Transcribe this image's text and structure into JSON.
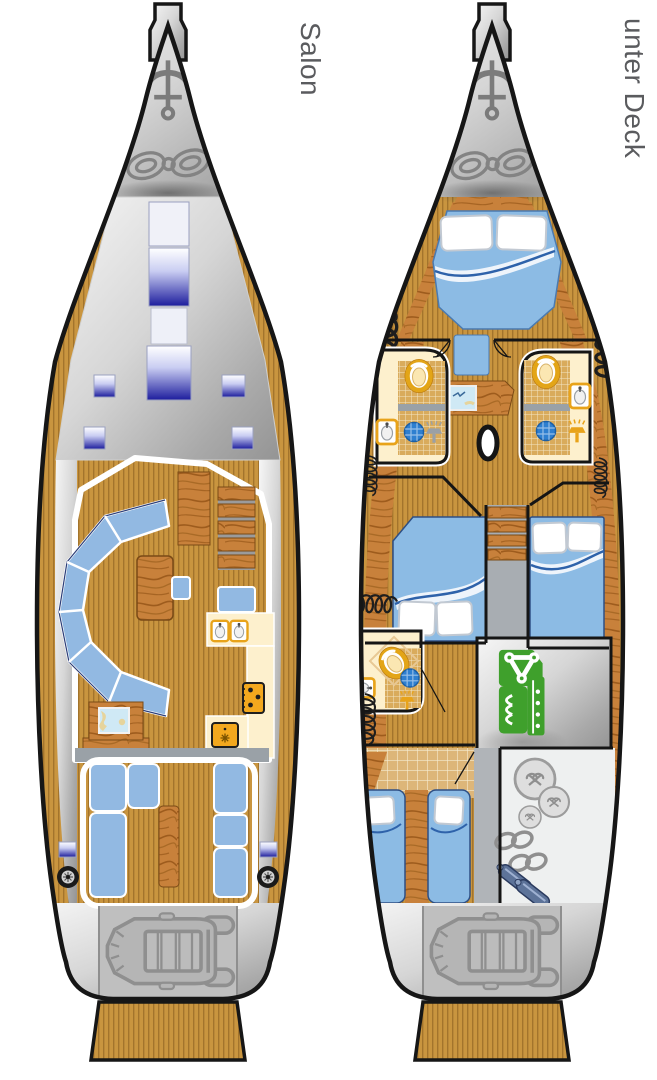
{
  "page": {
    "width": 657,
    "height": 1080,
    "background": "#ffffff",
    "type": "sailing-yacht-layout-diagram"
  },
  "labels": {
    "salon": "Salon",
    "lower_deck": "unter Deck"
  },
  "palette": {
    "label_gray": "#5a5b5e",
    "hull_outline": "#161616",
    "teak": "#c9953f",
    "teak_stripe": "#a3742c",
    "wood": "#c8813b",
    "wood_grain": "#9e5c1d",
    "deck_silver_light": "#f6f6f6",
    "deck_silver_dark": "#949494",
    "hatch_navy": "#1d1d9d",
    "cushion_blue": "#92b9e2",
    "bed_blue": "#8cbbe4",
    "galley_cream": "#fdf0cd",
    "appliance_orange": "#f3a81e",
    "drain_blue": "#2e7fd0",
    "engine_green": "#3fa02c",
    "bulkhead_gray": "#9aa1a7",
    "storage_gray": "#eef0f0",
    "map_blue": "#cfe9f5"
  },
  "decks": [
    {
      "id": "salon-deck",
      "label": "Salon",
      "features": [
        "bow-anchor",
        "rope-locker",
        "deck-skylights",
        "u-shaped-settee",
        "salon-table",
        "stool",
        "sideboard",
        "companionway-steps",
        "nav-seat",
        "galley-double-sink",
        "stove",
        "fridge",
        "chart-table",
        "cockpit-seating",
        "cockpit-table",
        "winch-port",
        "winch-starboard",
        "stern-hatches",
        "dinghy-garage",
        "swim-platform"
      ]
    },
    {
      "id": "lower-deck",
      "label": "unter Deck",
      "features": [
        "bow-anchor",
        "rope-locker",
        "forward-v-berth",
        "hanging-wardrobes",
        "head-port",
        "head-starboard",
        "head-aft",
        "toilets",
        "wash-basins",
        "shower-drains",
        "seat",
        "chart-desk",
        "mast",
        "double-bed-port",
        "double-bed-starboard",
        "companionway-stairs",
        "engine-room",
        "aft-single-beds",
        "storage-fenders-ropes",
        "dinghy-garage",
        "swim-platform"
      ]
    }
  ],
  "icons": [
    "anchor-icon",
    "rope-coil-icon",
    "skylight-hatch",
    "winch-icon",
    "dinghy-icon",
    "toilet-icon",
    "wash-basin-icon",
    "shower-head-icon",
    "shower-drain-icon",
    "wardrobe-squiggle-icon",
    "engine-icon",
    "fender-ball-icon",
    "rope-eight-icon",
    "fender-icon",
    "mast-icon",
    "stove-icon",
    "fridge-icon",
    "sink-icon",
    "map-icon"
  ]
}
